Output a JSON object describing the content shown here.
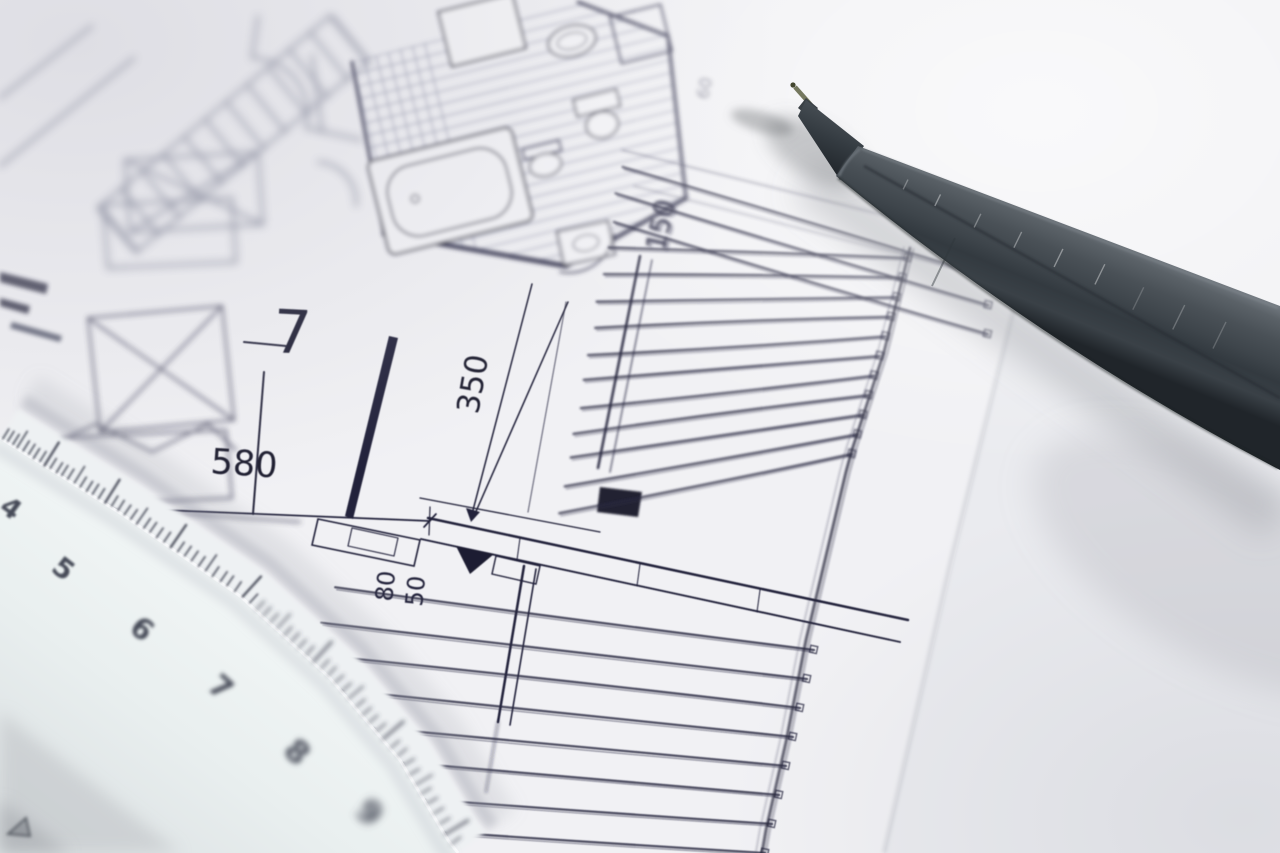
{
  "blueprint": {
    "room_number": "7",
    "dim_580": "580",
    "dim_350": "350",
    "dim_80": "80",
    "dim_50": "50",
    "dim_150": "150",
    "dim_60": "60"
  },
  "ruler": {
    "numbers": [
      "4",
      "5",
      "6",
      "7",
      "8",
      "9"
    ]
  },
  "colors": {
    "paper": "#f1f1f4",
    "ink": "#26263c",
    "pen_body": "#454d53",
    "ruler_face": "#edf2f3"
  }
}
